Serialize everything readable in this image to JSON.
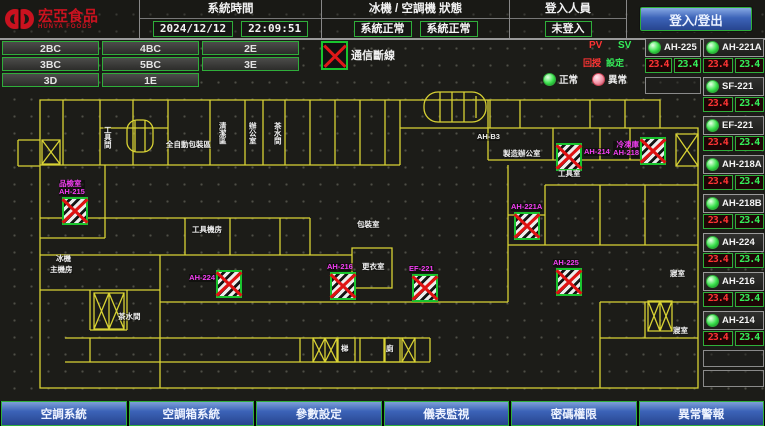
{
  "header": {
    "logo_text": "宏亞食品",
    "logo_subtext": "HUNYA FOODS",
    "system_time_label": "系統時間",
    "date": "2024/12/12",
    "time": "22:09:51",
    "machine_status_label": "冰機 / 空調機 狀態",
    "chiller_status": "系統正常",
    "ahu_status": "系統正常",
    "login_label": "登入人員",
    "login_status": "未登入",
    "login_button": "登入/登出"
  },
  "floor_buttons": [
    "2BC",
    "4BC",
    "2E",
    "3BC",
    "5BC",
    "3E",
    "3D",
    "1E"
  ],
  "legend": {
    "comm_lost_label": "通信斷線",
    "normal_label": "正常",
    "abnormal_label": "異常",
    "pv_header": "PV",
    "sv_header": "SV",
    "pv_label": "回授",
    "sv_label": "設定"
  },
  "panel": {
    "left_unit": {
      "name": "AH-225",
      "pv": "23.4",
      "sv": "23.4"
    },
    "units": [
      {
        "name": "AH-221A",
        "pv": "23.4",
        "sv": "23.4"
      },
      {
        "name": "SF-221",
        "pv": "23.4",
        "sv": "23.4"
      },
      {
        "name": "EF-221",
        "pv": "23.4",
        "sv": "23.4"
      },
      {
        "name": "AH-218A",
        "pv": "23.4",
        "sv": "23.4"
      },
      {
        "name": "AH-218B",
        "pv": "23.4",
        "sv": "23.4"
      },
      {
        "name": "AH-224",
        "pv": "23.4",
        "sv": "23.4"
      },
      {
        "name": "AH-216",
        "pv": "23.4",
        "sv": "23.4"
      },
      {
        "name": "AH-214",
        "pv": "23.4",
        "sv": "23.4"
      }
    ]
  },
  "floorplan": {
    "units": [
      {
        "room": "品檢室",
        "name": "AH-215",
        "x": 62,
        "y": 197,
        "cls": "above"
      },
      {
        "name": "AH-224",
        "x": 216,
        "y": 270,
        "cls": "left"
      },
      {
        "name": "AH-216",
        "x": 330,
        "y": 272,
        "cls": "above"
      },
      {
        "name": "EF-221",
        "x": 412,
        "y": 274,
        "cls": "above"
      },
      {
        "name": "AH-221A",
        "x": 514,
        "y": 212,
        "cls": "above"
      },
      {
        "name": "AH-225",
        "x": 556,
        "y": 268,
        "cls": "above"
      },
      {
        "name": "AH-214",
        "x": 556,
        "y": 143,
        "cls": "right"
      },
      {
        "room": "冷凍庫",
        "name": "AH-218",
        "x": 640,
        "y": 137,
        "cls": "left"
      }
    ],
    "labels": [
      {
        "text": "工具間",
        "x": 103,
        "y": 126,
        "cls": "vert"
      },
      {
        "text": "全自動包裝區",
        "x": 166,
        "y": 141
      },
      {
        "text": "清潔區",
        "x": 218,
        "y": 122,
        "cls": "vert"
      },
      {
        "text": "辦公室",
        "x": 248,
        "y": 122,
        "cls": "vert"
      },
      {
        "text": "茶水間",
        "x": 273,
        "y": 122,
        "cls": "vert"
      },
      {
        "text": "AH-B3",
        "x": 477,
        "y": 133
      },
      {
        "text": "製造辦公室",
        "x": 503,
        "y": 150
      },
      {
        "text": "工具室",
        "x": 558,
        "y": 170
      },
      {
        "text": "包裝室",
        "x": 357,
        "y": 221
      },
      {
        "text": "工具機房",
        "x": 192,
        "y": 226
      },
      {
        "text": "更衣室",
        "x": 362,
        "y": 263
      },
      {
        "text": "冰機",
        "x": 56,
        "y": 255
      },
      {
        "text": "主機房",
        "x": 50,
        "y": 266
      },
      {
        "text": "茶水間",
        "x": 118,
        "y": 313
      },
      {
        "text": "梯",
        "x": 341,
        "y": 345
      },
      {
        "text": "廁",
        "x": 386,
        "y": 345
      },
      {
        "text": "寢室",
        "x": 670,
        "y": 270
      },
      {
        "text": "寢室",
        "x": 673,
        "y": 327
      }
    ]
  },
  "bottom_nav": [
    "空調系統",
    "空調箱系統",
    "參數設定",
    "儀表監視",
    "密碼權限",
    "異常警報"
  ],
  "colors": {
    "accent_green": "#2fae3a",
    "alarm_red": "#e01212",
    "magenta": "#f23df2",
    "wall_yellow": "#d8d234",
    "nav_blue": "#3c63b8"
  }
}
